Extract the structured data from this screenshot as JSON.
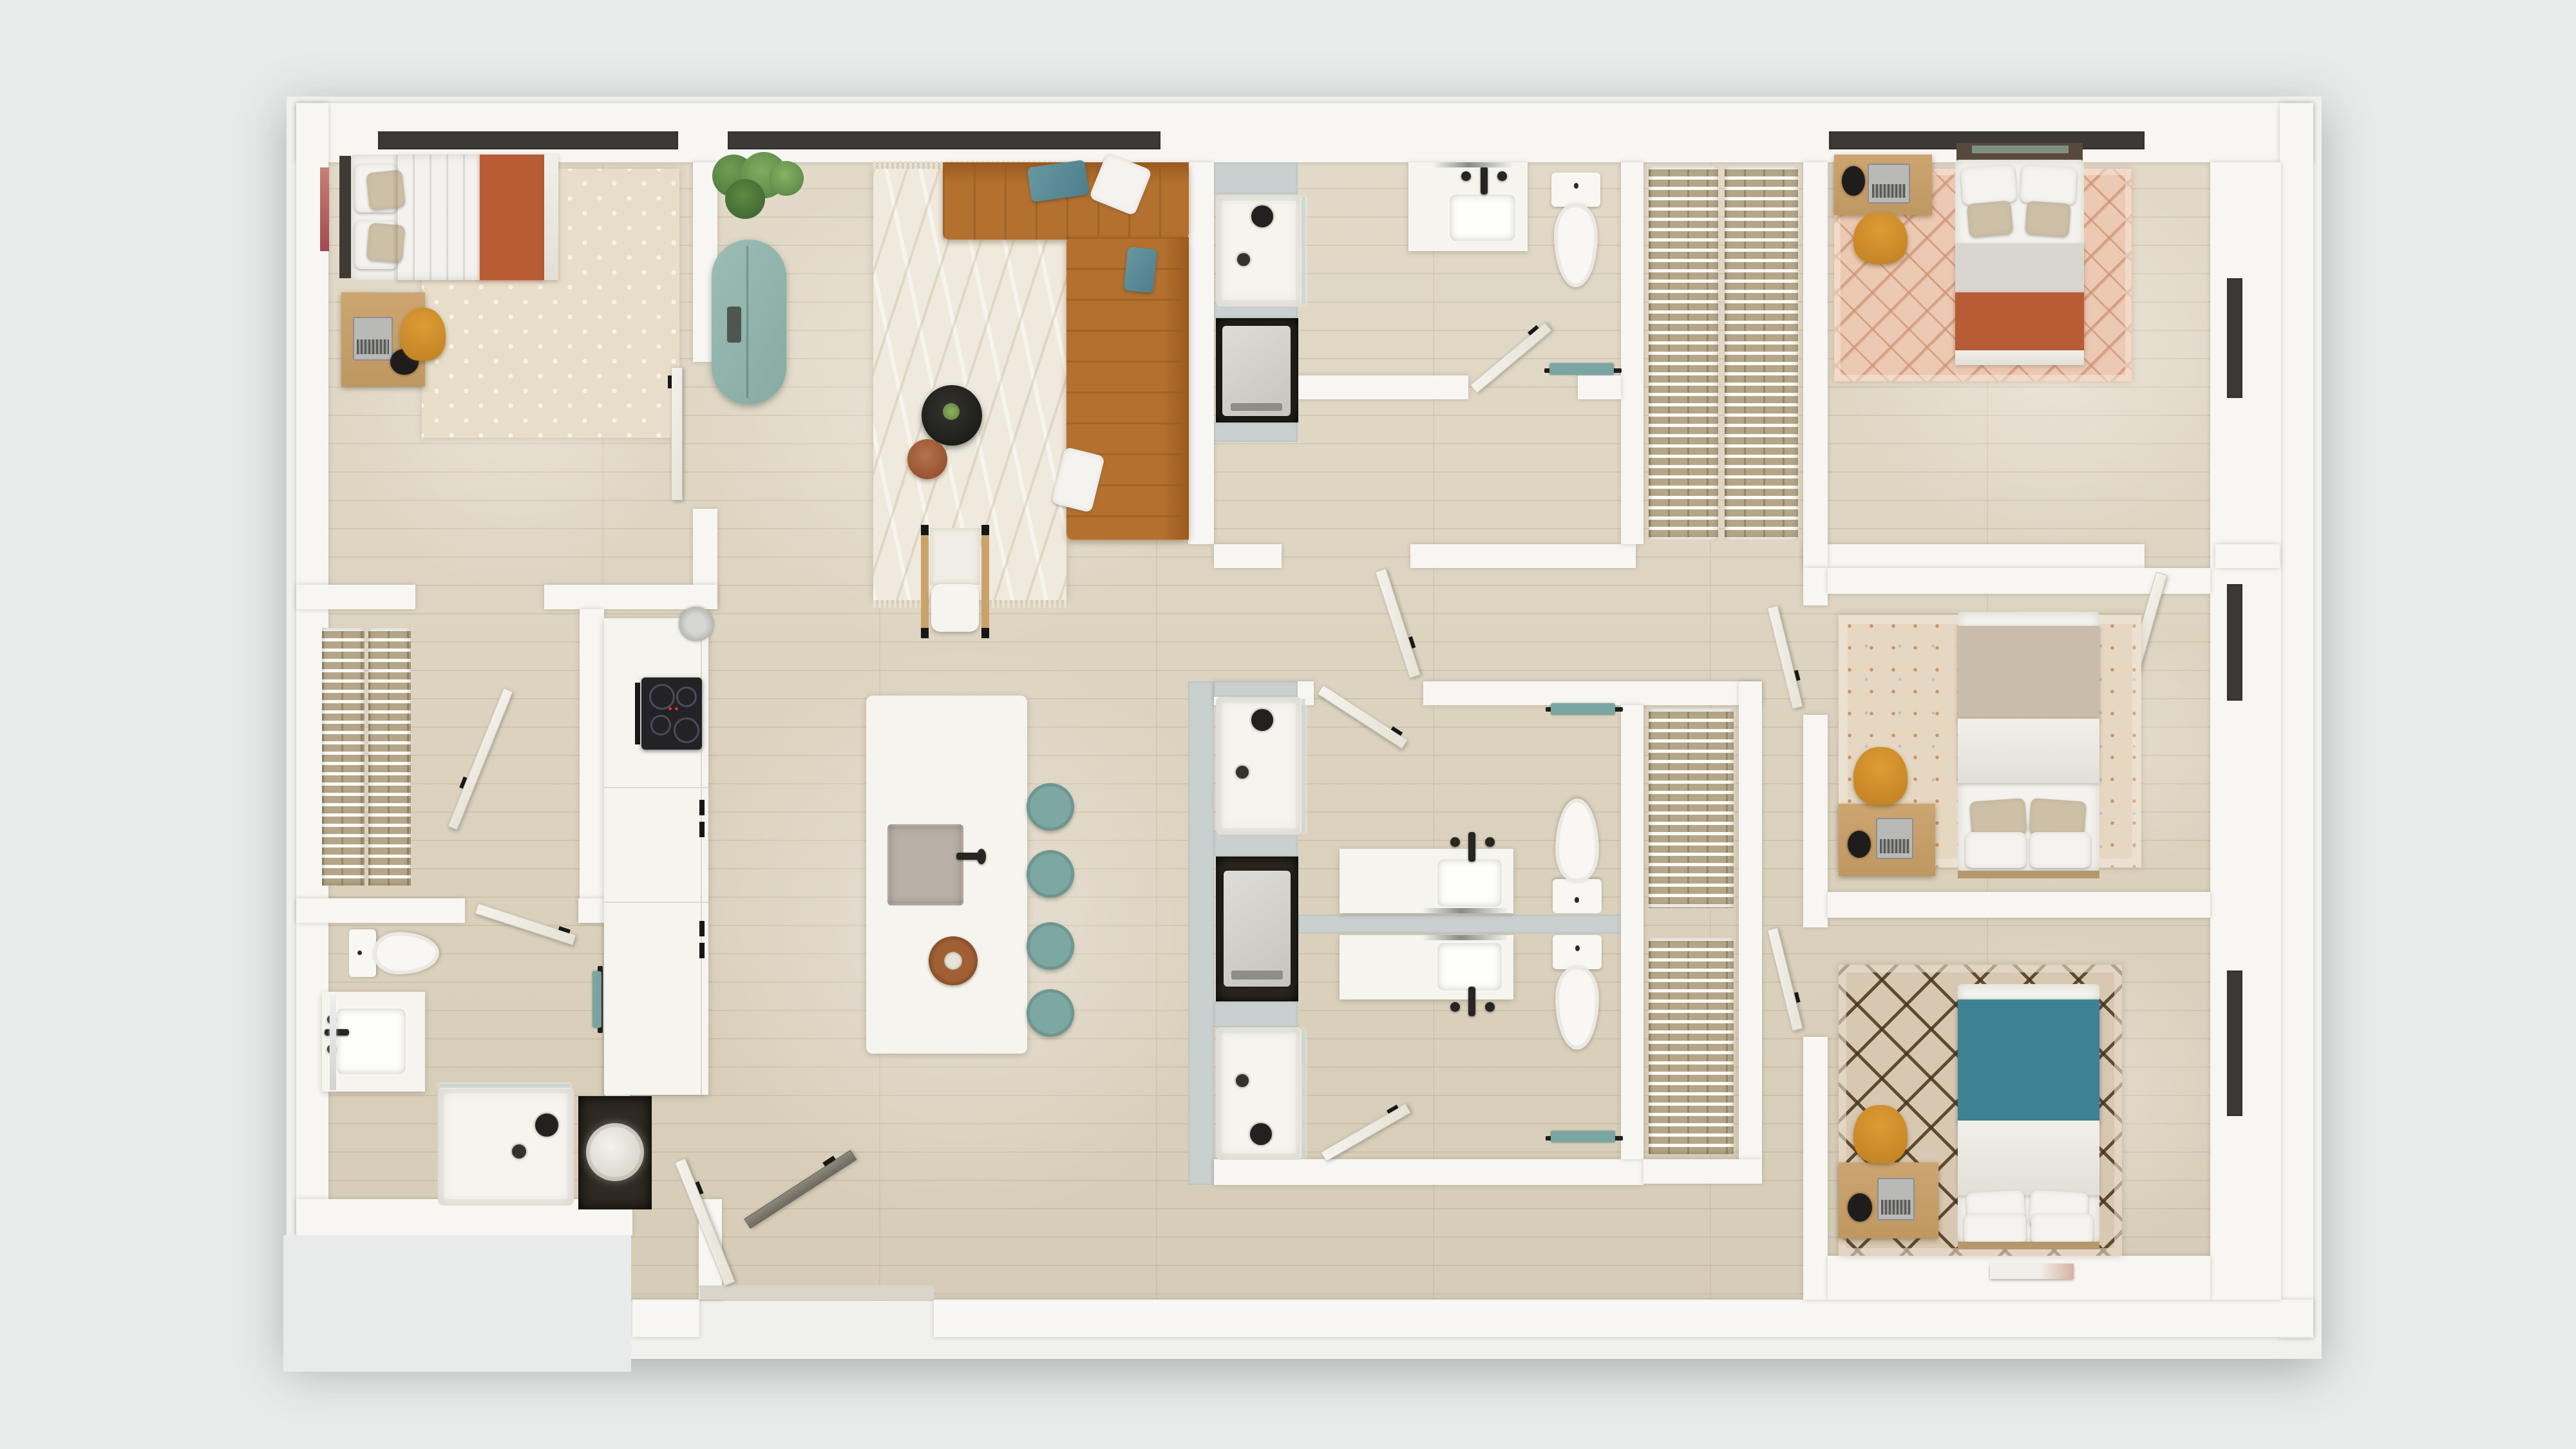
{
  "scene": {
    "kind": "architectural-floor-plan",
    "render_style": "photorealistic 3d top-down dollhouse render",
    "background": "plain light gray, no text or labels visible",
    "rooms": [
      {
        "name": "bedroom-top-left",
        "furniture": [
          "double-bed-white-terracotta-throw",
          "dark-headboard",
          "beige-pillows",
          "cream-cross-pattern-rug",
          "wood-desk",
          "laptop",
          "black-desk-lamp",
          "mustard-desk-chair",
          "window",
          "door"
        ]
      },
      {
        "name": "walk-in-closet-left",
        "furniture": [
          "white-wire-shelving-with-clothes",
          "open-door"
        ]
      },
      {
        "name": "bathroom-bottom-left",
        "furniture": [
          "toilet",
          "vanity-with-sink",
          "mirror",
          "walk-in-shower-glass",
          "towel-bar",
          "door"
        ]
      },
      {
        "name": "kitchen",
        "furniture": [
          "counter-run",
          "black-induction-cooktop-with-oven",
          "round-vent",
          "fridge-cabinet",
          "island-with-gray-sink",
          "black-faucet",
          "round-wood-serving-board",
          "four-teal-stools"
        ]
      },
      {
        "name": "utility-water-heater-closet",
        "furniture": [
          "round-white-water-heater-tank"
        ]
      },
      {
        "name": "living-dining",
        "furniture": [
          "l-shaped-cognac-tufted-sectional",
          "teal-velvet-pillows",
          "white-pillows",
          "cream-wavy-rug-with-fringe",
          "black-round-coffee-table-with-plant",
          "terracotta-round-side-table",
          "white-boucle-accent-chair-wood-frame",
          "sage-teal-pill-credenza",
          "fiddle-leaf-plant",
          "window-wall"
        ]
      },
      {
        "name": "entry",
        "furniture": [
          "white-door-leaf",
          "dark-door-leaf",
          "threshold"
        ]
      },
      {
        "name": "hallway",
        "furniture": [
          "open-door-leaves"
        ]
      },
      {
        "name": "bathroom-top-middle",
        "furniture": [
          "walk-in-shower",
          "laundry-niche-with-washer",
          "vanity-with-sink",
          "toilet",
          "teal-towel-bar",
          "door"
        ]
      },
      {
        "name": "walk-in-closet-top-right",
        "furniture": [
          "double-wire-shelving-with-clothes"
        ]
      },
      {
        "name": "bedroom-top-right",
        "furniture": [
          "bed-terracotta-blanket",
          "white-and-beige-pillows",
          "pink-diamond-rug",
          "wood-desk",
          "laptop",
          "black-desk-lamp",
          "mustard-desk-chair",
          "window",
          "door"
        ]
      },
      {
        "name": "bathroom-middle-a",
        "furniture": [
          "walk-in-shower",
          "vanity-with-sink",
          "toilet",
          "teal-towel-bar",
          "door"
        ]
      },
      {
        "name": "bathroom-middle-b",
        "furniture": [
          "walk-in-shower",
          "vanity-with-sink",
          "toilet",
          "teal-towel-bar",
          "door"
        ]
      },
      {
        "name": "laundry-niche-middle",
        "furniture": [
          "stacked-washer"
        ]
      },
      {
        "name": "walk-in-closet-middle",
        "furniture": [
          "wire-shelving-with-clothes"
        ]
      },
      {
        "name": "bedroom-middle-right",
        "furniture": [
          "bed-taupe-blanket",
          "beige-and-white-pillows",
          "beige-floral-rug",
          "wood-desk",
          "laptop",
          "black-desk-lamp",
          "mustard-desk-chair",
          "window"
        ]
      },
      {
        "name": "bedroom-bottom-right",
        "furniture": [
          "bed-teal-blanket",
          "four-white-pillows",
          "brown-trellis-rug",
          "wood-desk",
          "laptop",
          "black-desk-lamp",
          "mustard-desk-chair",
          "magazine",
          "window"
        ]
      }
    ],
    "fixture_counts": {
      "bedrooms": 4,
      "bathrooms": 4,
      "showers": 4,
      "toilets": 4,
      "vanities": 4,
      "walk_in_closets": 3,
      "washer_niches": 2,
      "water_heater_tanks": 1,
      "island_stools": 4,
      "beds": 4,
      "desks": 4
    }
  },
  "palette": {
    "bg": "#e9ebeb",
    "wall": "#f7f6f2",
    "wall-gray": "#c9d0cf",
    "wood": "#dcd2bd",
    "fixture": "#f5f4ef",
    "window-dark": "#3b3a37",
    "niche": "#2f2a22",
    "shelf": "#b4a689",
    "sofa": "#b4702f",
    "sofa-dark": "#9a5a20",
    "terracotta": "#b85c35",
    "teal-blanket": "#3e8195",
    "teal-towel": "#79a5a2",
    "stool": "#7ca7a2",
    "credenza": "#92b6ae",
    "mustard": "#dd9c34",
    "desk": "#cda571",
    "beige": "#cdc0a7",
    "taupe": "#c9bcaa",
    "rug-cream": "#e7ddc8",
    "gray-sink": "#b8b0a6",
    "plant-green": "#6f9e52",
    "bedframe": "#b6986c",
    "coffee-table": "#232322",
    "side-table": "#a9653e"
  }
}
